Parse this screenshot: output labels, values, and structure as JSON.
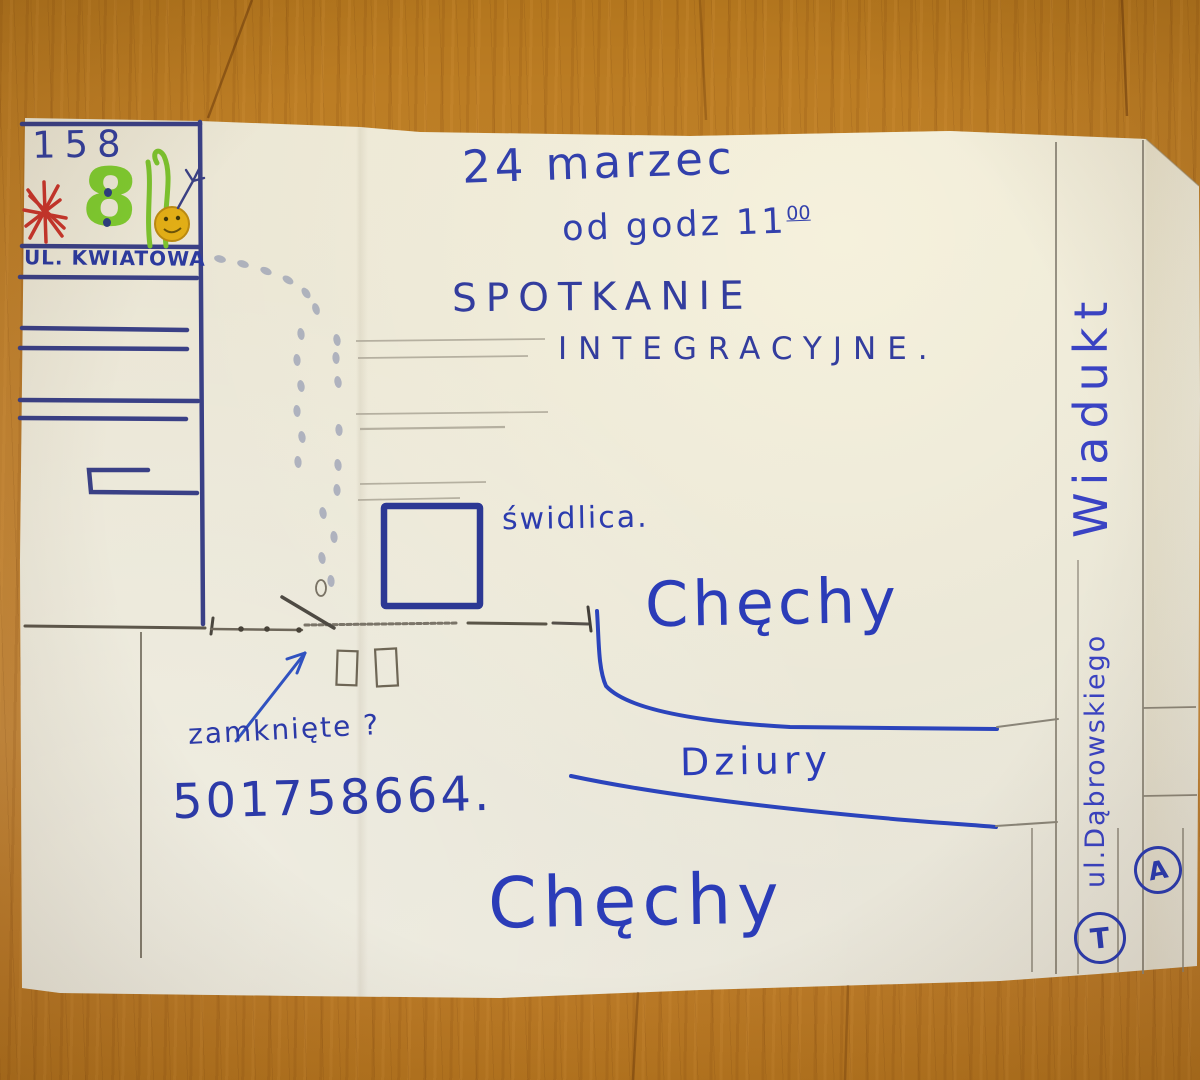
{
  "paper_note": {
    "event": {
      "date": "24 marzec",
      "time_prefix": "od godz 11",
      "time_superscript": "00",
      "title_line1": "SPOTKANIE",
      "title_line2": "INTEGRACYJNE."
    },
    "landmarks": {
      "house_number": "158",
      "green_house_number": "8",
      "street_kwiatowa": "ul. Kwiatowa",
      "venue": "świdlica.",
      "village_upper": "Chęchy",
      "village_lower": "Chęchy",
      "road_condition": "Dziury",
      "viaduct": "Wiadukt",
      "street_dabrowskiego": "ul.Dąbrowskiego",
      "stop_a": "A",
      "stop_t": "T"
    },
    "annotations": {
      "gate_question": "zamknięte ?",
      "phone": "501758664."
    },
    "colors": {
      "ink_blue": "#2b3cb8",
      "marker_navy": "#3a4086",
      "pencil_gray": "#8a8578",
      "accent_red": "#c8362c",
      "accent_green": "#7fca30",
      "accent_yellow": "#e2ae16",
      "paper": "#eae6d6",
      "wood": "#bd7c2a"
    }
  }
}
